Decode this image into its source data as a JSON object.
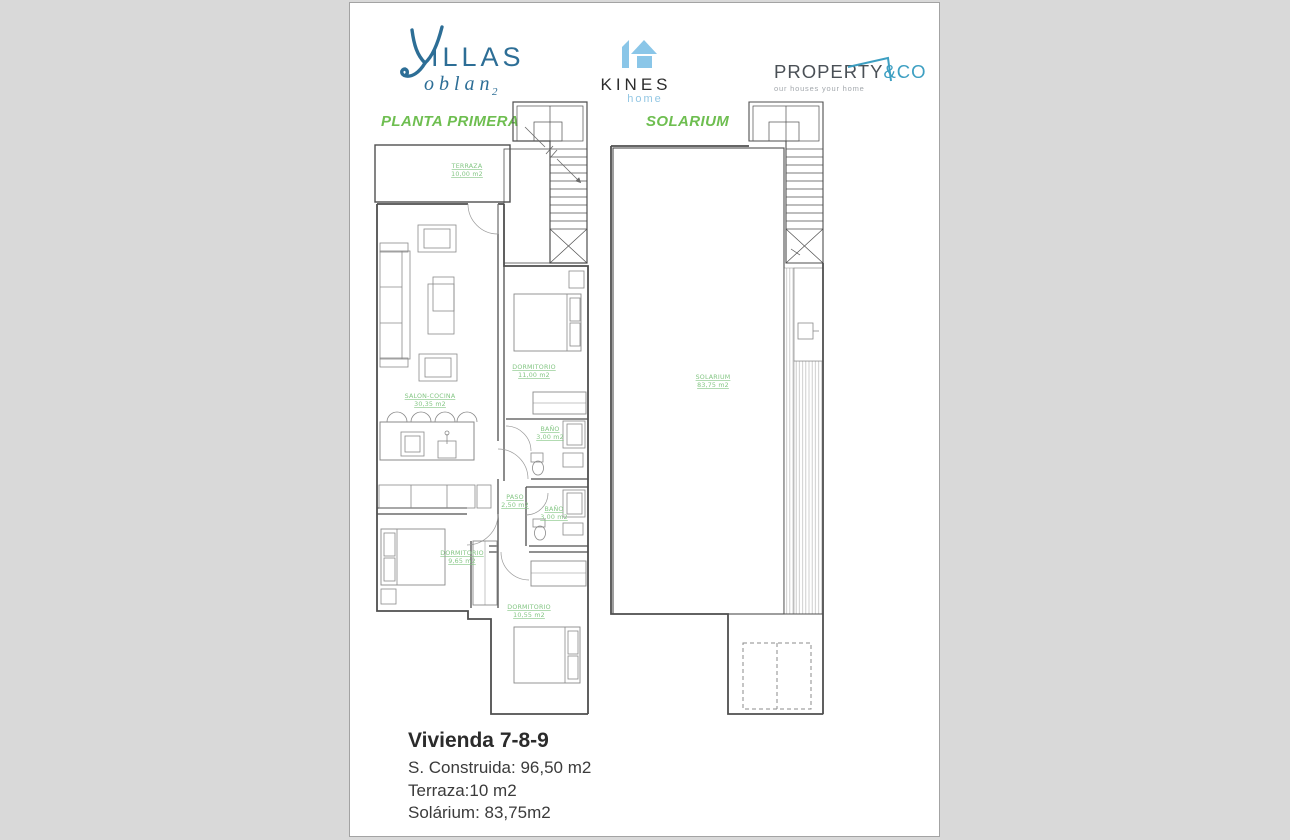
{
  "header": {
    "villas_logo": {
      "wordmark_rest": "ILLAS",
      "submark": "oblan",
      "subscript": "2",
      "color": "#2d6e96"
    },
    "kines_logo": {
      "name": "KINES",
      "tagline": "home",
      "icon_color": "#8ac6e8",
      "name_color": "#2c2c2c",
      "tagline_color": "#93c7e4"
    },
    "property_logo": {
      "name": "PROPERTY",
      "suffix": "&CO",
      "tagline": "our houses your home",
      "name_color": "#4a5056",
      "accent_color": "#3d9fc2"
    }
  },
  "plans": {
    "left": {
      "title": "PLANTA PRIMERA",
      "rooms": [
        {
          "name": "TERRAZA",
          "area": "10,00 m2"
        },
        {
          "name": "SALON-COCINA",
          "area": "30,35 m2"
        },
        {
          "name": "DORMITORIO",
          "area": "11,00 m2"
        },
        {
          "name": "BAÑO",
          "area": "3,00 m2"
        },
        {
          "name": "PASO",
          "area": "2,50 m2"
        },
        {
          "name": "BAÑO",
          "area": "3,00 m2"
        },
        {
          "name": "DORMITORIO",
          "area": "9,65 m2"
        },
        {
          "name": "DORMITORIO",
          "area": "10,55 m2"
        }
      ]
    },
    "right": {
      "title": "SOLARIUM",
      "rooms": [
        {
          "name": "SOLARIUM",
          "area": "83,75 m2"
        }
      ]
    }
  },
  "summary": {
    "title": "Vivienda 7-8-9",
    "lines": [
      "S. Construida: 96,50 m2",
      "Terraza:10 m2",
      "Solárium: 83,75m2"
    ]
  },
  "colors": {
    "page_background": "#d9d9d9",
    "sheet_background": "#ffffff",
    "title_green": "#6ebe50",
    "room_label_green": "#84c684",
    "wall_gray": "#4f4f4f",
    "hatch_gray": "#c2c2c2"
  }
}
